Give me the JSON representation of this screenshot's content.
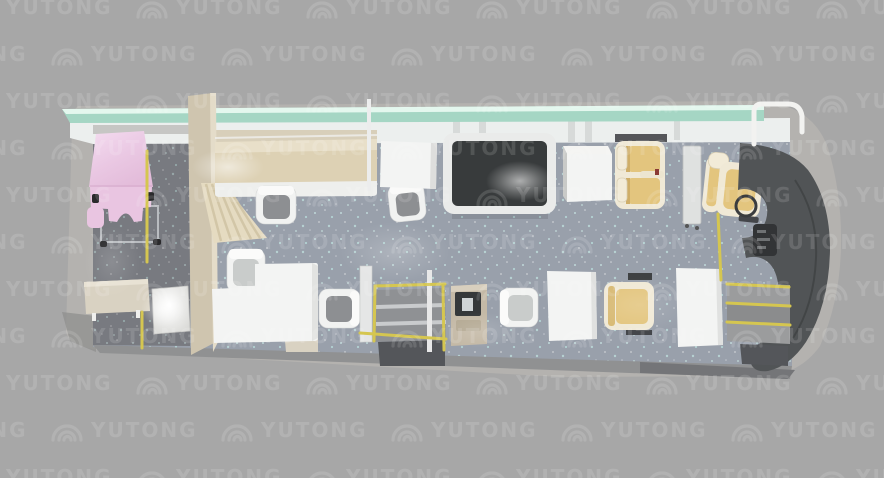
{
  "watermark": {
    "text": "YUTONG",
    "logo_icon": "yutong-arcs-logo",
    "color": "#ffffff",
    "opacity": 0.13,
    "grid": {
      "x_period": 170,
      "y_period": 47,
      "start_y": -6,
      "even_row_offset": -35,
      "odd_row_offset": 50,
      "rows": 11
    }
  },
  "palette": {
    "background": "#a7a7a7",
    "bus_wall": "#b4b2af",
    "rear_wall_shade": "#8f8f8e",
    "window_glass": "#a5d6c4",
    "window_glass_light": "#e4f7ee",
    "top_wall": "#ecefee",
    "wall_pillar": "#d7dad9",
    "floor_main": "#99a0ab",
    "floor_rear": "#75767c",
    "bottom_wall": "#909192",
    "step_well_dark": "#54565a",
    "bench_beige": "#ddd1b4",
    "bench_trim": "#d8cfba",
    "partition_beige": "#cfc5af",
    "curtain_beige": "#e5dbc1",
    "curtain_pleat": "#d2c6a7",
    "exam_bed_pink": "#e9c5e1",
    "exam_bed_pink_light": "#f4dcf0",
    "desk_beige": "#d9d2c2",
    "table_white": "#f3f4f3",
    "chair_seat_gray": "#8d8f92",
    "chair_seat_light": "#c9cccb",
    "dark_table_top": "#45484a",
    "cabinet_side": "#c9cac8",
    "seat_tan": "#e3c57e",
    "seat_cream": "#f0e9d6",
    "dashboard_dark": "#515456",
    "instrument_dark": "#323436",
    "rail_yellow": "#d5c650",
    "kiosk_beige": "#c4b9a6",
    "kiosk_screen": "#35383a"
  }
}
